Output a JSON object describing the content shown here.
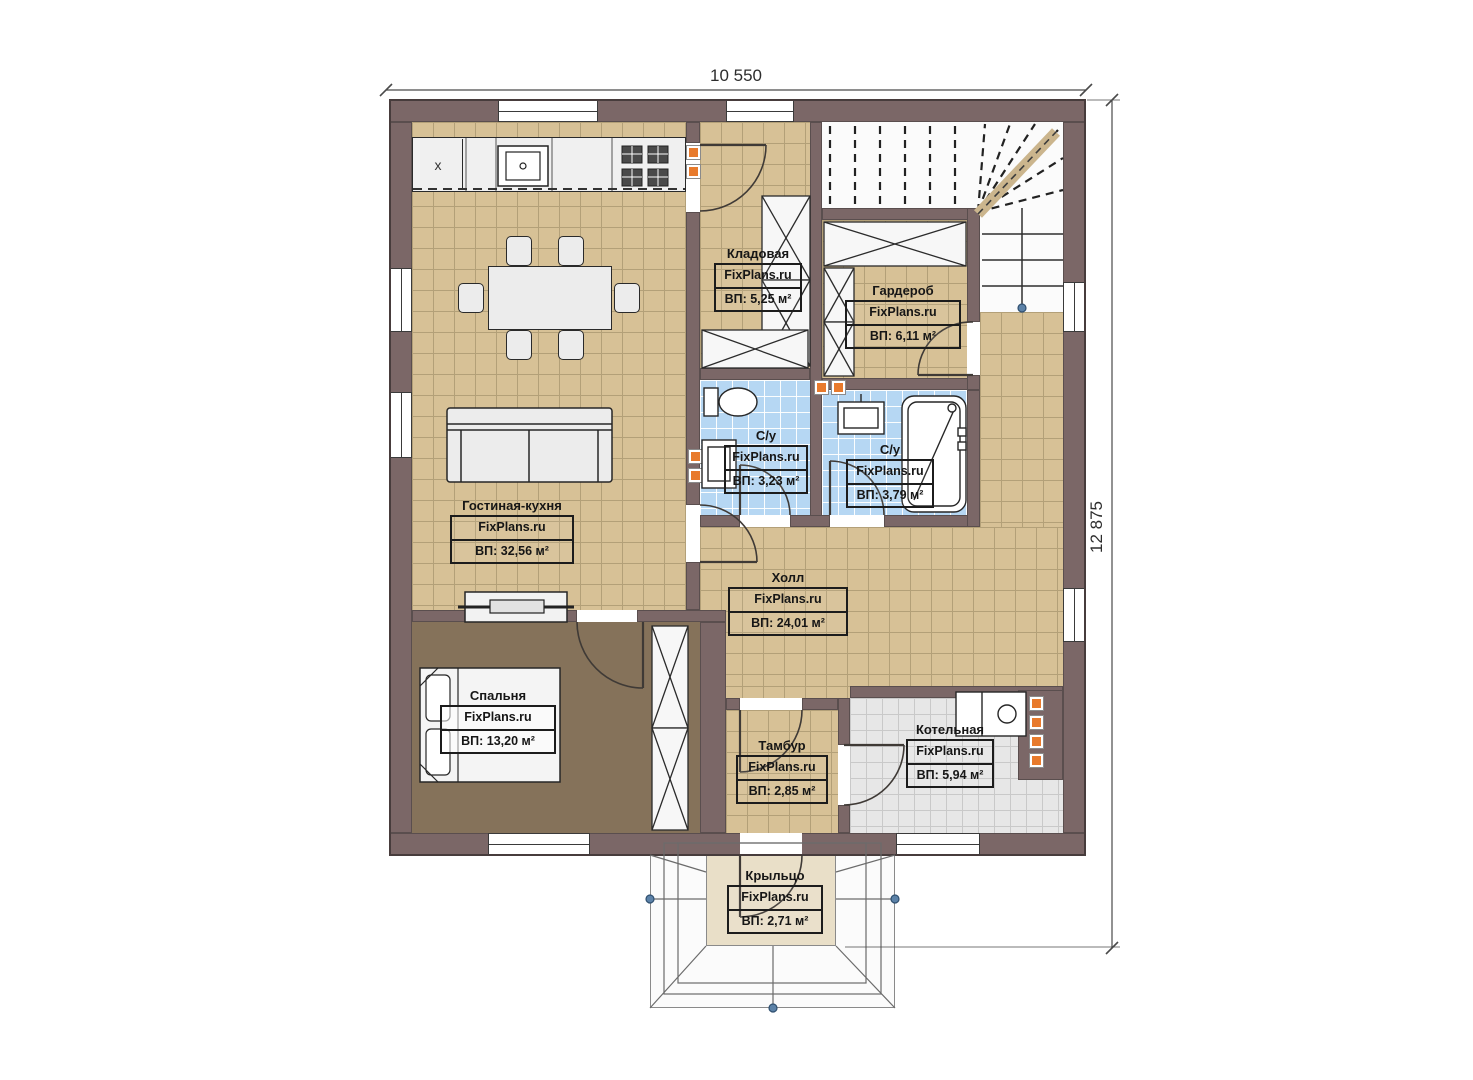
{
  "dimensions": {
    "width_label": "10 550",
    "height_label": "12 875"
  },
  "kitchen": {
    "corner_mark": "x"
  },
  "rooms": [
    {
      "id": "living-kitchen",
      "name": "Гостиная-кухня",
      "brand": "FixPlans.ru",
      "area": "ВП: 32,56 м²"
    },
    {
      "id": "storage",
      "name": "Кладовая",
      "brand": "FixPlans.ru",
      "area": "ВП: 5,25 м²"
    },
    {
      "id": "wardrobe",
      "name": "Гардероб",
      "brand": "FixPlans.ru",
      "area": "ВП: 6,11 м²"
    },
    {
      "id": "bathroom-1",
      "name": "С/у",
      "brand": "FixPlans.ru",
      "area": "ВП: 3,23 м²"
    },
    {
      "id": "bathroom-2",
      "name": "С/у",
      "brand": "FixPlans.ru",
      "area": "ВП: 3,79 м²"
    },
    {
      "id": "hall",
      "name": "Холл",
      "brand": "FixPlans.ru",
      "area": "ВП: 24,01 м²"
    },
    {
      "id": "bedroom",
      "name": "Спальня",
      "brand": "FixPlans.ru",
      "area": "ВП: 13,20 м²"
    },
    {
      "id": "vestibule",
      "name": "Тамбур",
      "brand": "FixPlans.ru",
      "area": "ВП: 2,85 м²"
    },
    {
      "id": "boiler-room",
      "name": "Котельная",
      "brand": "FixPlans.ru",
      "area": "ВП: 5,94 м²"
    },
    {
      "id": "porch",
      "name": "Крыльцо",
      "brand": "FixPlans.ru",
      "area": "ВП: 2,71 м²"
    }
  ],
  "palette": {
    "wall": "#7b6767",
    "floor_tile": "#d7c196",
    "bedroom_floor": "#85725a",
    "bathroom_tile": "#b6d7f3",
    "boiler_tile": "#e7e7e7",
    "porch_platform": "#e9dfc8",
    "accent_orange": "#e87a2c",
    "node_blue": "#5c82a8"
  }
}
